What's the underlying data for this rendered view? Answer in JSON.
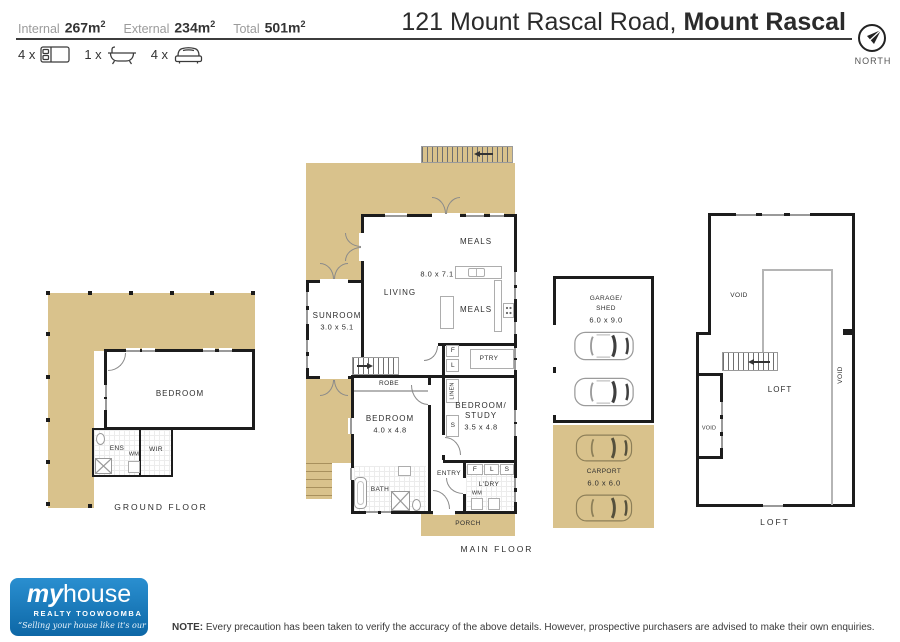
{
  "header": {
    "stats": [
      {
        "label": "Internal",
        "value": "267m",
        "sup": "2"
      },
      {
        "label": "External",
        "value": "234m",
        "sup": "2"
      },
      {
        "label": "Total",
        "value": "501m",
        "sup": "2"
      }
    ],
    "features": [
      {
        "count": "4 x",
        "icon": "bed-icon"
      },
      {
        "count": "1 x",
        "icon": "bath-icon"
      },
      {
        "count": "4 x",
        "icon": "car-icon"
      }
    ],
    "title_regular": "121 Mount Rascal Road,",
    "title_bold": "Mount Rascal",
    "compass_label": "NORTH"
  },
  "plans": {
    "ground_floor": {
      "caption": "GROUND FLOOR",
      "bedroom": "BEDROOM",
      "ens": "ENS",
      "wir": "WIR",
      "wm": "WM"
    },
    "main_floor": {
      "caption": "MAIN FLOOR",
      "sunroom": "SUNROOM",
      "sunroom_dim": "3.0 x 5.1",
      "living": "LIVING",
      "living_dim": "8.0 x 7.1",
      "meals": "MEALS",
      "ptry": "PTRY",
      "robe": "ROBE",
      "linen": "LINEN",
      "bedroom": "BEDROOM",
      "bedroom_dim": "4.0 x 4.8",
      "bedroom_study_line1": "BEDROOM/",
      "bedroom_study_line2": "STUDY",
      "bedroom_study_dim": "3.5 x 4.8",
      "entry": "ENTRY",
      "bath": "BATH",
      "ldry": "L'DRY",
      "porch": "PORCH",
      "wm": "WM",
      "f": "F",
      "l": "L",
      "s": "S"
    },
    "garage": {
      "name_line1": "GARAGE/",
      "name_line2": "SHED",
      "dim": "6.0 x 9.0"
    },
    "carport": {
      "name": "CARPORT",
      "dim": "6.0 x 6.0"
    },
    "loft": {
      "caption": "LOFT",
      "room": "LOFT",
      "void": "VOID"
    }
  },
  "footer": {
    "logo_my": "my",
    "logo_house": "house",
    "logo_sub": "REALTY TOOWOOMBA",
    "logo_tagline": "“Selling your house like it's our house...”",
    "note_label": "NOTE:",
    "note_text": "Every precaution has been taken to verify the accuracy of the above details. However, prospective purchasers are advised to make their own enquiries."
  },
  "colors": {
    "deck": "#d9c28c",
    "wall": "#1c1c1c",
    "logo_blue": "#1478bc"
  }
}
